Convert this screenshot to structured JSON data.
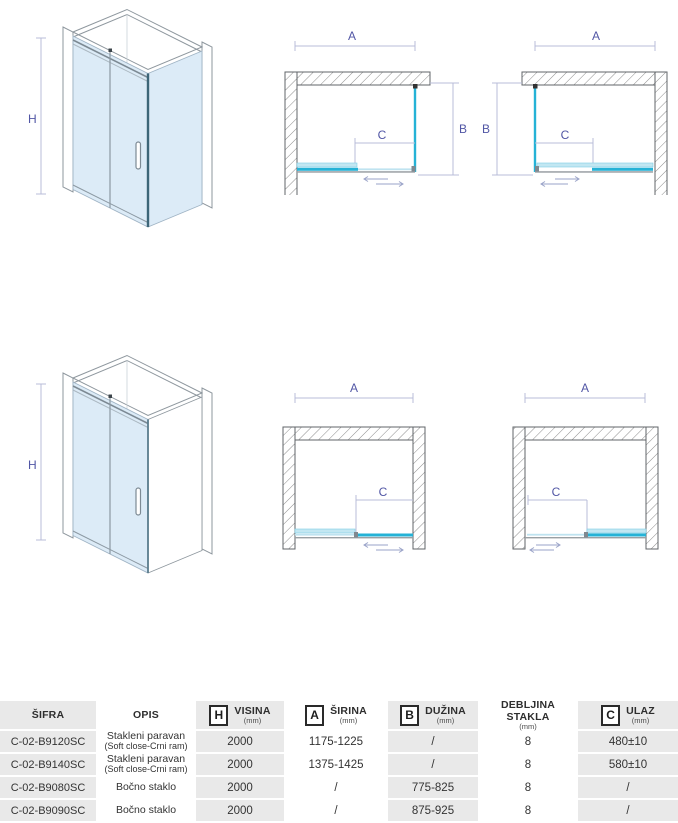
{
  "diagrams": {
    "labels": {
      "h": "H",
      "a": "A",
      "b": "B",
      "c": "C"
    }
  },
  "colors": {
    "glass_cyan": "#25b2d6",
    "glass_pale": "#c2e7f2",
    "glass_iso": "#dcebf7",
    "track_gray": "#9aa0a4",
    "dim_label": "#5156a5",
    "table_gray": "#e9e9e9"
  },
  "table": {
    "headers": {
      "sifra": {
        "title": "ŠIFRA"
      },
      "opis": {
        "title": "OPIS"
      },
      "visina": {
        "letter": "H",
        "title": "VISINA",
        "unit": "(mm)"
      },
      "sirina": {
        "letter": "A",
        "title": "ŠIRINA",
        "unit": "(mm)"
      },
      "duzina": {
        "letter": "B",
        "title": "DUŽINA",
        "unit": "(mm)"
      },
      "debljina": {
        "title": "DEBLJINA STAKLA",
        "unit": "(mm)"
      },
      "ulaz": {
        "letter": "C",
        "title": "ULAZ",
        "unit": "(mm)"
      }
    },
    "rows": [
      {
        "sifra": "C-02-B9120SC",
        "opis1": "Stakleni paravan",
        "opis2": "(Soft close-Crni ram)",
        "visina": "2000",
        "sirina": "1175-1225",
        "duzina": "/",
        "debljina": "8",
        "ulaz": "480±10"
      },
      {
        "sifra": "C-02-B9140SC",
        "opis1": "Stakleni paravan",
        "opis2": "(Soft close-Crni ram)",
        "visina": "2000",
        "sirina": "1375-1425",
        "duzina": "/",
        "debljina": "8",
        "ulaz": "580±10"
      },
      {
        "sifra": "C-02-B9080SC",
        "opis1": "Bočno staklo",
        "opis2": "",
        "visina": "2000",
        "sirina": "/",
        "duzina": "775-825",
        "debljina": "8",
        "ulaz": "/"
      },
      {
        "sifra": "C-02-B9090SC",
        "opis1": "Bočno staklo",
        "opis2": "",
        "visina": "2000",
        "sirina": "/",
        "duzina": "875-925",
        "debljina": "8",
        "ulaz": "/"
      }
    ]
  }
}
